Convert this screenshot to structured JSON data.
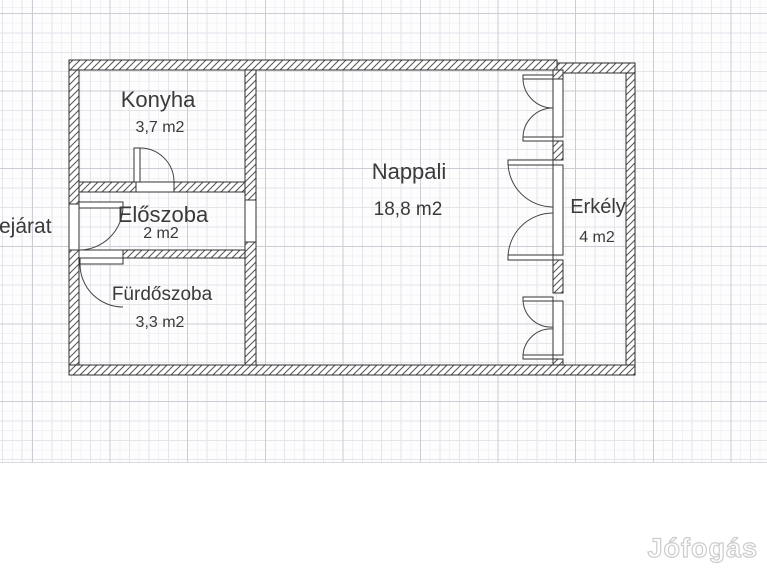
{
  "floorplan": {
    "rooms": [
      {
        "id": "konyha",
        "name": "Konyha",
        "area": "3,7 m2"
      },
      {
        "id": "eloszoba",
        "name": "Előszoba",
        "area": "2 m2"
      },
      {
        "id": "furdoszoba",
        "name": "Fürdőszoba",
        "area": "3,3 m2"
      },
      {
        "id": "nappali",
        "name": "Nappali",
        "area": "18,8 m2"
      },
      {
        "id": "erkely",
        "name": "Erkély",
        "area": "4 m2"
      }
    ],
    "entrance_label": "Bejárat"
  },
  "watermark": {
    "text": "Jófogás"
  },
  "colors": {
    "wall_outline": "#2e2e2e",
    "hatch_line": "#5a5a5a",
    "door_arc": "#444444",
    "label_text": "#3a3a3a",
    "grid_fine": "#f2f2f6",
    "grid_medium": "#e4e4ea",
    "grid_major": "#ccccd4",
    "watermark_outline": "#cccccc"
  }
}
